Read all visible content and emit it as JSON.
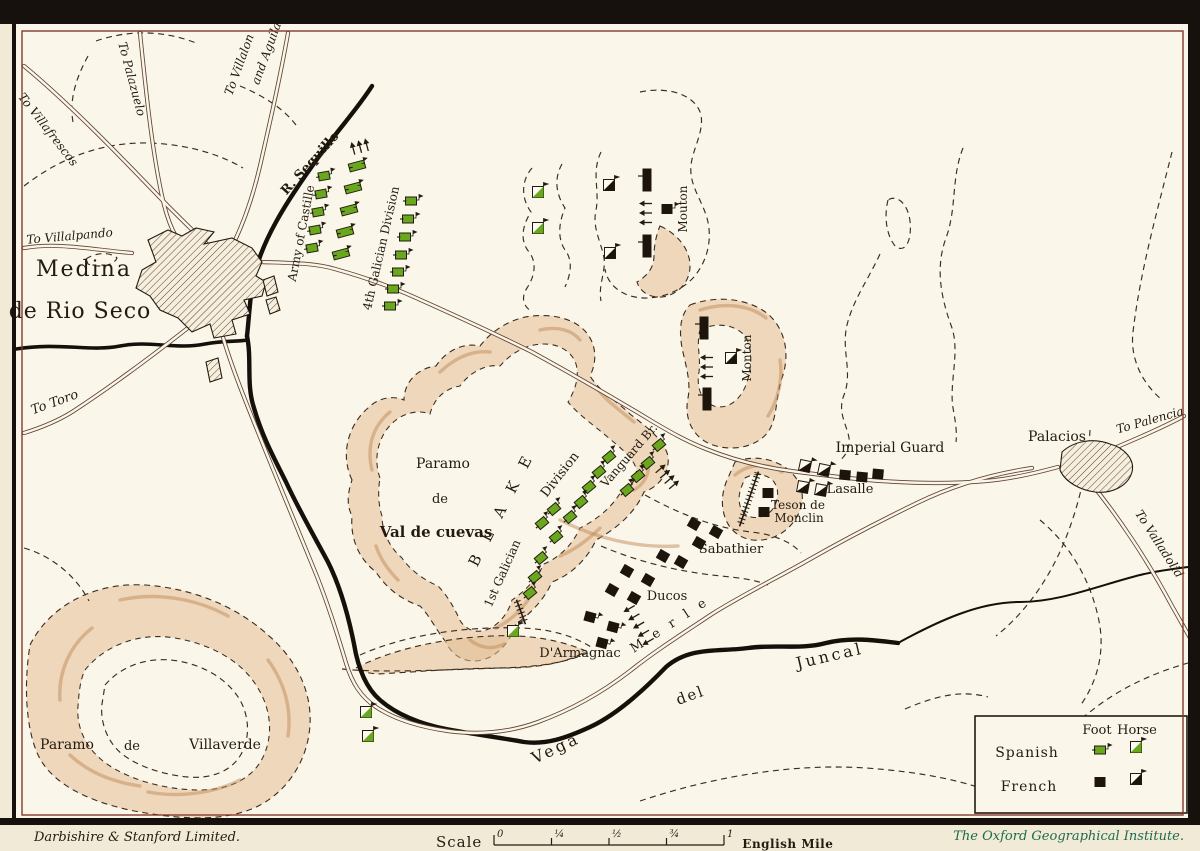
{
  "colors": {
    "spanish": "#69a81e",
    "french": "#1d150c",
    "ink": "#241b10",
    "paper": "#fbf6ea",
    "hill_tan": "#e3bd93",
    "footer_green": "#1e6a4e"
  },
  "legend": {
    "foot": "Foot",
    "horse": "Horse",
    "spanish": "Spanish",
    "french": "French"
  },
  "footer": {
    "left": "Darbishire & Stanford Limited.",
    "scale_label": "Scale",
    "scale_ticks": [
      "0",
      "¼",
      "½",
      "¾",
      "1"
    ],
    "unit_label": "English Mile",
    "right": "The Oxford Geographical Institute."
  },
  "map": {
    "labels": [
      {
        "t": "To Villafrescos",
        "x": 45,
        "y": 132,
        "r": 52,
        "s": 12,
        "i": 1
      },
      {
        "t": "To Palazuelo",
        "x": 128,
        "y": 80,
        "r": 75,
        "s": 12,
        "i": 1
      },
      {
        "t": "To Villalon",
        "x": 243,
        "y": 66,
        "r": -70,
        "s": 12,
        "i": 1
      },
      {
        "t": "and Aguilar",
        "x": 271,
        "y": 52,
        "r": -70,
        "s": 12,
        "i": 1
      },
      {
        "t": "To Villalpando",
        "x": 70,
        "y": 240,
        "r": -5,
        "s": 12,
        "i": 1
      },
      {
        "t": "Medina",
        "x": 84,
        "y": 276,
        "r": 0,
        "s": 22,
        "ls": 2
      },
      {
        "t": "de Rio Seco",
        "x": 80,
        "y": 318,
        "r": 0,
        "s": 22,
        "ls": 1
      },
      {
        "t": "To Toro",
        "x": 56,
        "y": 406,
        "r": -20,
        "s": 13,
        "i": 1
      },
      {
        "t": "R. Sequillo",
        "x": 313,
        "y": 166,
        "r": -48,
        "s": 13,
        "b": 1
      },
      {
        "t": "Army of Castille",
        "x": 305,
        "y": 234,
        "r": -79,
        "s": 12
      },
      {
        "t": "4th Galician Division",
        "x": 385,
        "y": 249,
        "r": -77,
        "s": 12
      },
      {
        "t": "Mouton",
        "x": 687,
        "y": 209,
        "r": -90,
        "s": 12
      },
      {
        "t": "Monton",
        "x": 751,
        "y": 358,
        "r": -90,
        "s": 12
      },
      {
        "t": "Paramo",
        "x": 443,
        "y": 468,
        "r": 0,
        "s": 14
      },
      {
        "t": "de",
        "x": 440,
        "y": 503,
        "r": 0,
        "s": 13
      },
      {
        "t": "Val de cuevas",
        "x": 436,
        "y": 537,
        "r": 0,
        "s": 15,
        "b": 1
      },
      {
        "t": "B L A K E",
        "x": 506,
        "y": 511,
        "r": -63,
        "s": 15,
        "ls": 6
      },
      {
        "t": "Division",
        "x": 563,
        "y": 477,
        "r": -52,
        "s": 13
      },
      {
        "t": "1st Galician",
        "x": 506,
        "y": 575,
        "r": -66,
        "s": 12
      },
      {
        "t": "Vanguard Br.",
        "x": 632,
        "y": 458,
        "r": -49,
        "s": 12
      },
      {
        "t": "Imperial Guard",
        "x": 890,
        "y": 452,
        "r": 0,
        "s": 14
      },
      {
        "t": "Lasalle",
        "x": 850,
        "y": 493,
        "r": 0,
        "s": 13
      },
      {
        "t": "Teson de",
        "x": 798,
        "y": 509,
        "r": 0,
        "s": 12
      },
      {
        "t": "Monclin",
        "x": 799,
        "y": 522,
        "r": 0,
        "s": 12
      },
      {
        "t": "Sabathier",
        "x": 731,
        "y": 553,
        "r": 0,
        "s": 13
      },
      {
        "t": "Ducos",
        "x": 667,
        "y": 600,
        "r": 0,
        "s": 13
      },
      {
        "t": "M e r l e",
        "x": 672,
        "y": 628,
        "r": -33,
        "s": 13,
        "ls": 4
      },
      {
        "t": "D'Armagnac",
        "x": 580,
        "y": 657,
        "r": 0,
        "s": 13
      },
      {
        "t": "Vega",
        "x": 558,
        "y": 753,
        "r": -25,
        "s": 16,
        "ls": 3
      },
      {
        "t": "del",
        "x": 692,
        "y": 700,
        "r": -20,
        "s": 15,
        "ls": 2
      },
      {
        "t": "Juncal",
        "x": 831,
        "y": 661,
        "r": -13,
        "s": 16,
        "ls": 3
      },
      {
        "t": "Paramo",
        "x": 67,
        "y": 749,
        "r": 0,
        "s": 14
      },
      {
        "t": "de",
        "x": 132,
        "y": 750,
        "r": 0,
        "s": 13
      },
      {
        "t": "Villaverde",
        "x": 225,
        "y": 749,
        "r": 0,
        "s": 14
      },
      {
        "t": "Palacios",
        "x": 1057,
        "y": 441,
        "r": 0,
        "s": 14
      },
      {
        "t": "To Palencia",
        "x": 1151,
        "y": 424,
        "r": -16,
        "s": 12,
        "i": 1
      },
      {
        "t": "To Valladolid",
        "x": 1156,
        "y": 546,
        "r": 57,
        "s": 12,
        "i": 1
      }
    ],
    "units": [
      {
        "t": "ar",
        "x": 360,
        "y": 147,
        "r": -15,
        "n": 3,
        "d": "up"
      },
      {
        "t": "sb",
        "x": 357,
        "y": 166,
        "r": -15
      },
      {
        "t": "sb",
        "x": 353,
        "y": 188,
        "r": -15
      },
      {
        "t": "sb",
        "x": 349,
        "y": 210,
        "r": -15
      },
      {
        "t": "sb",
        "x": 345,
        "y": 232,
        "r": -15
      },
      {
        "t": "sb",
        "x": 341,
        "y": 254,
        "r": -15
      },
      {
        "t": "sf",
        "x": 324,
        "y": 176,
        "r": -10
      },
      {
        "t": "sf",
        "x": 321,
        "y": 194,
        "r": -10
      },
      {
        "t": "sf",
        "x": 318,
        "y": 212,
        "r": -10
      },
      {
        "t": "sf",
        "x": 315,
        "y": 230,
        "r": -10
      },
      {
        "t": "sf",
        "x": 312,
        "y": 248,
        "r": -10
      },
      {
        "t": "sf",
        "x": 411,
        "y": 201,
        "r": 0
      },
      {
        "t": "sf",
        "x": 408,
        "y": 219,
        "r": 0
      },
      {
        "t": "sf",
        "x": 405,
        "y": 237,
        "r": 0
      },
      {
        "t": "sf",
        "x": 401,
        "y": 255,
        "r": 0
      },
      {
        "t": "sf",
        "x": 398,
        "y": 272,
        "r": 0
      },
      {
        "t": "sf",
        "x": 393,
        "y": 289,
        "r": 0
      },
      {
        "t": "sf",
        "x": 390,
        "y": 306,
        "r": 0
      },
      {
        "t": "sh",
        "x": 538,
        "y": 192,
        "r": 0
      },
      {
        "t": "sh",
        "x": 538,
        "y": 228,
        "r": 0
      },
      {
        "t": "fb",
        "x": 647,
        "y": 180,
        "r": 0
      },
      {
        "t": "ar",
        "x": 646,
        "y": 213,
        "r": 0,
        "n": 3,
        "d": "left"
      },
      {
        "t": "ff",
        "x": 667,
        "y": 209,
        "r": 0,
        "fl": 1
      },
      {
        "t": "fb",
        "x": 647,
        "y": 246,
        "r": 0
      },
      {
        "t": "fh",
        "x": 609,
        "y": 185,
        "r": 0
      },
      {
        "t": "fh",
        "x": 610,
        "y": 253,
        "r": 0
      },
      {
        "t": "fb",
        "x": 704,
        "y": 328,
        "r": 0
      },
      {
        "t": "ar",
        "x": 707,
        "y": 367,
        "r": 0,
        "n": 3,
        "d": "left"
      },
      {
        "t": "fh",
        "x": 731,
        "y": 358,
        "r": 0
      },
      {
        "t": "fb",
        "x": 707,
        "y": 399,
        "r": 0
      },
      {
        "t": "sf",
        "x": 659,
        "y": 445,
        "r": -40
      },
      {
        "t": "sf",
        "x": 648,
        "y": 463,
        "r": -40
      },
      {
        "t": "sf",
        "x": 638,
        "y": 476,
        "r": -40
      },
      {
        "t": "sf",
        "x": 627,
        "y": 490,
        "r": -40
      },
      {
        "t": "ar",
        "x": 667,
        "y": 477,
        "r": 50,
        "n": 4,
        "d": "up"
      },
      {
        "t": "sf",
        "x": 609,
        "y": 457,
        "r": -40
      },
      {
        "t": "sf",
        "x": 599,
        "y": 472,
        "r": -40
      },
      {
        "t": "sf",
        "x": 589,
        "y": 487,
        "r": -40
      },
      {
        "t": "sf",
        "x": 581,
        "y": 502,
        "r": -40
      },
      {
        "t": "sf",
        "x": 570,
        "y": 517,
        "r": -40
      },
      {
        "t": "sf",
        "x": 554,
        "y": 509,
        "r": -40
      },
      {
        "t": "sf",
        "x": 542,
        "y": 523,
        "r": -40
      },
      {
        "t": "sf",
        "x": 556,
        "y": 537,
        "r": -40
      },
      {
        "t": "sf",
        "x": 541,
        "y": 558,
        "r": -40
      },
      {
        "t": "sf",
        "x": 535,
        "y": 577,
        "r": -40
      },
      {
        "t": "sf",
        "x": 530,
        "y": 593,
        "r": -40
      },
      {
        "t": "art",
        "x": 521,
        "y": 612,
        "r": -20,
        "len": 26
      },
      {
        "t": "sh",
        "x": 513,
        "y": 631,
        "r": 0
      },
      {
        "t": "sh",
        "x": 366,
        "y": 712,
        "r": 0
      },
      {
        "t": "sh",
        "x": 368,
        "y": 736,
        "r": 0
      },
      {
        "t": "fh",
        "x": 805,
        "y": 466,
        "r": 12
      },
      {
        "t": "fh",
        "x": 824,
        "y": 470,
        "r": 12
      },
      {
        "t": "ff",
        "x": 845,
        "y": 475,
        "r": 5
      },
      {
        "t": "ff",
        "x": 862,
        "y": 477,
        "r": 5
      },
      {
        "t": "ff",
        "x": 878,
        "y": 474,
        "r": 5
      },
      {
        "t": "fh",
        "x": 803,
        "y": 487,
        "r": 10
      },
      {
        "t": "fh",
        "x": 821,
        "y": 490,
        "r": 10
      },
      {
        "t": "art",
        "x": 749,
        "y": 499,
        "r": 19,
        "len": 58
      },
      {
        "t": "ff",
        "x": 768,
        "y": 493,
        "r": 0
      },
      {
        "t": "ff",
        "x": 764,
        "y": 512,
        "r": 0
      },
      {
        "t": "ff",
        "x": 694,
        "y": 524,
        "r": 30
      },
      {
        "t": "ff",
        "x": 716,
        "y": 532,
        "r": 30
      },
      {
        "t": "ff",
        "x": 699,
        "y": 543,
        "r": 30
      },
      {
        "t": "ff",
        "x": 663,
        "y": 556,
        "r": 30
      },
      {
        "t": "ff",
        "x": 681,
        "y": 562,
        "r": 30
      },
      {
        "t": "ff",
        "x": 627,
        "y": 571,
        "r": 30
      },
      {
        "t": "ff",
        "x": 648,
        "y": 580,
        "r": 30
      },
      {
        "t": "ff",
        "x": 612,
        "y": 590,
        "r": 30
      },
      {
        "t": "ff",
        "x": 634,
        "y": 598,
        "r": 30
      },
      {
        "t": "ar",
        "x": 639,
        "y": 625,
        "r": -30,
        "n": 5,
        "d": "left"
      },
      {
        "t": "ff",
        "x": 590,
        "y": 617,
        "r": 15,
        "fl": 1
      },
      {
        "t": "ff",
        "x": 613,
        "y": 627,
        "r": 15,
        "fl": 1
      },
      {
        "t": "ff",
        "x": 602,
        "y": 643,
        "r": 15,
        "fl": 1
      },
      {
        "t": "sf",
        "x": 1100,
        "y": 750,
        "r": 0
      },
      {
        "t": "sh",
        "x": 1136,
        "y": 747,
        "r": 0
      },
      {
        "t": "ff",
        "x": 1100,
        "y": 782,
        "r": 0
      },
      {
        "t": "fh",
        "x": 1136,
        "y": 779,
        "r": 0
      }
    ]
  }
}
